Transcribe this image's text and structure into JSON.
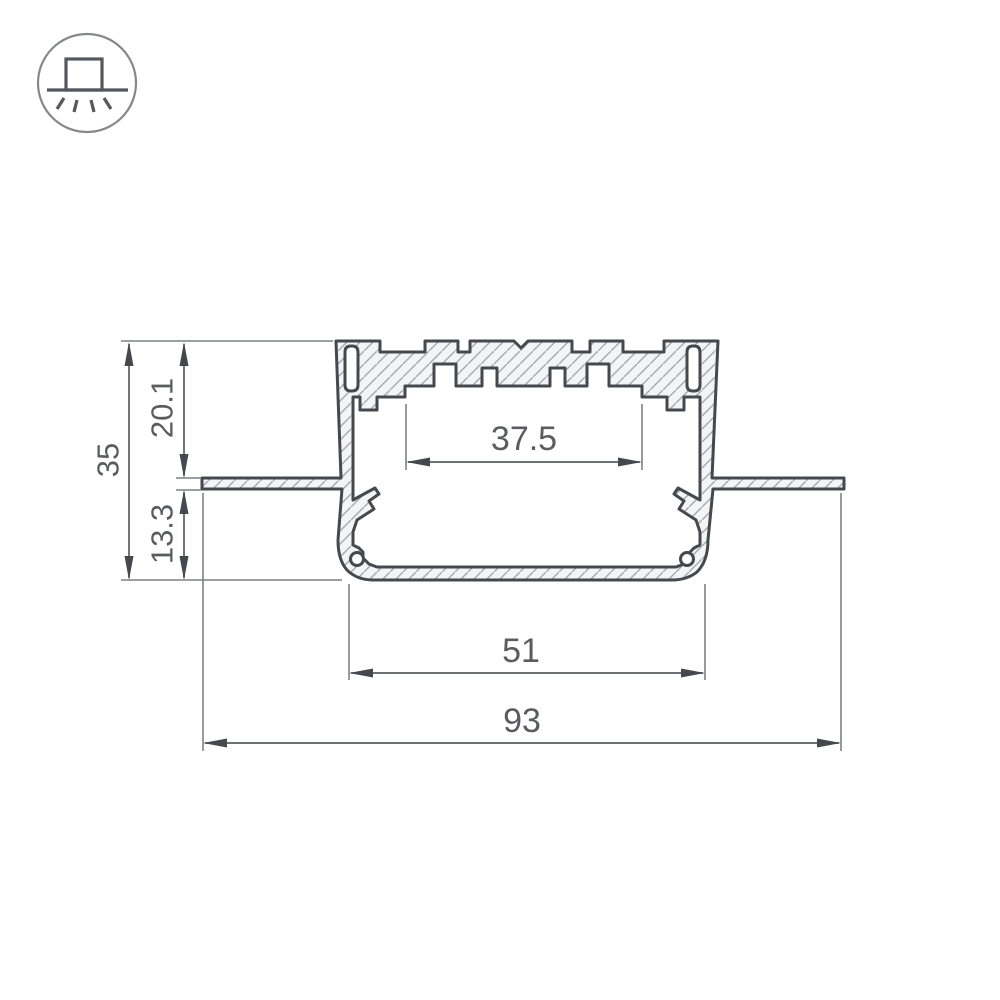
{
  "drawing": {
    "kind": "aluminum-led-profile-cross-section"
  },
  "icon": {
    "name": "recessed-mount-light-icon"
  },
  "dims": {
    "overall_height": "35",
    "upper_depth": "20.1",
    "lower_depth": "13.3",
    "inner_width": "37.5",
    "body_width": "51",
    "overall_width": "93"
  },
  "colors": {
    "background": "#ffffff",
    "profile_outline": "#45494d",
    "profile_fill": "#f3f4f5",
    "hatch_line": "#a6abaf",
    "dimension_line": "#7e8286",
    "dimension_text": "#595d61",
    "icon_stroke": "#54585c",
    "icon_circle": "#85898d"
  }
}
